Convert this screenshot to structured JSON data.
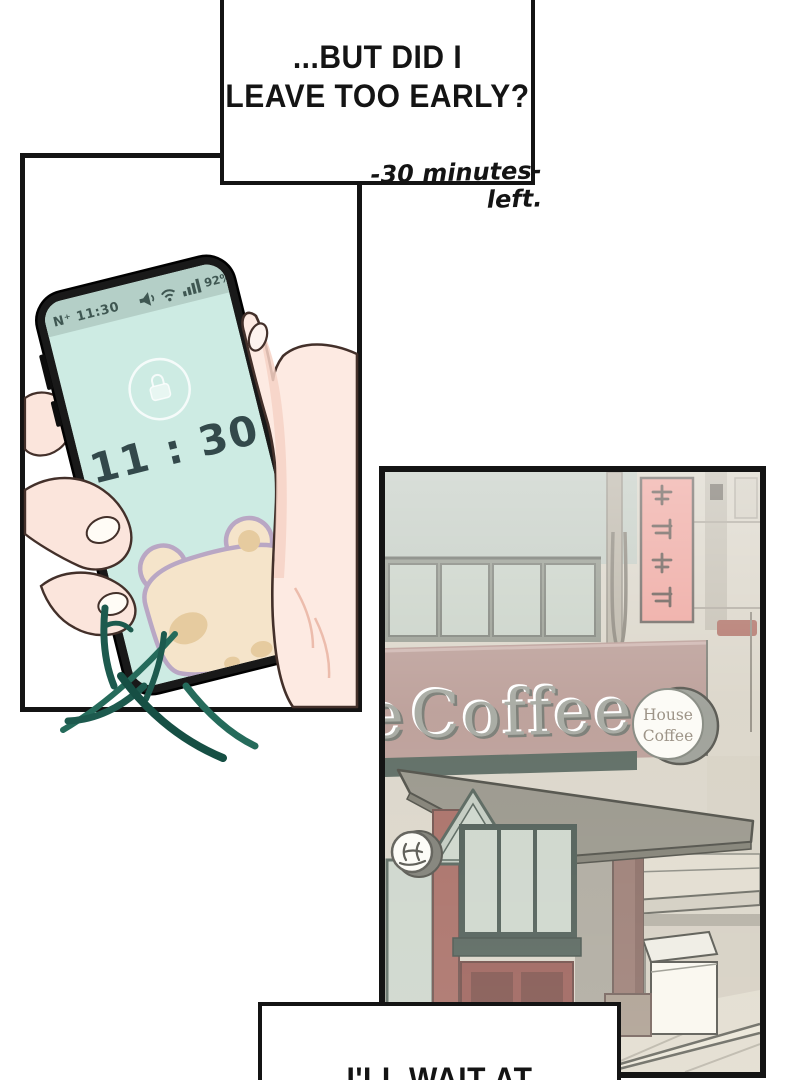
{
  "speech_top": {
    "line1": "...BUT DID I",
    "line2": "LEAVE TOO EARLY?"
  },
  "caption": {
    "text": "-30 minutes- left."
  },
  "speech_bottom": {
    "text": "I'LL WAIT AT"
  },
  "phone": {
    "status_time": "N⁺ 11:30",
    "battery_percent": "92%",
    "clock": "11 : 30",
    "colors": {
      "screen": "#cdebe3",
      "status_bar": "#b4cfc7",
      "frame": "#191919",
      "clock_text": "#33494b",
      "status_text": "#3f5752",
      "bear_body": "#f5e4ca",
      "bear_outline": "#b9a7c4",
      "bear_patch": "#e6cb9f",
      "leaves": "#1d5a4e"
    }
  },
  "coffee_shop": {
    "sign_partial_letter": "e",
    "sign_text": "Coffee",
    "round_sign_line1": "House",
    "round_sign_line2": "Coffee",
    "colors": {
      "red_sign": "#ec9b93",
      "sign_band": "#b2918a",
      "awning": "#8a877a",
      "wall": "#d6d0c2",
      "glass": "#c2ccc0",
      "sage": "#bcc6bc",
      "storefront_red": "#9c5a50",
      "lower_panel_red": "#8e4a42",
      "pavement": "#ddd7c7"
    }
  }
}
